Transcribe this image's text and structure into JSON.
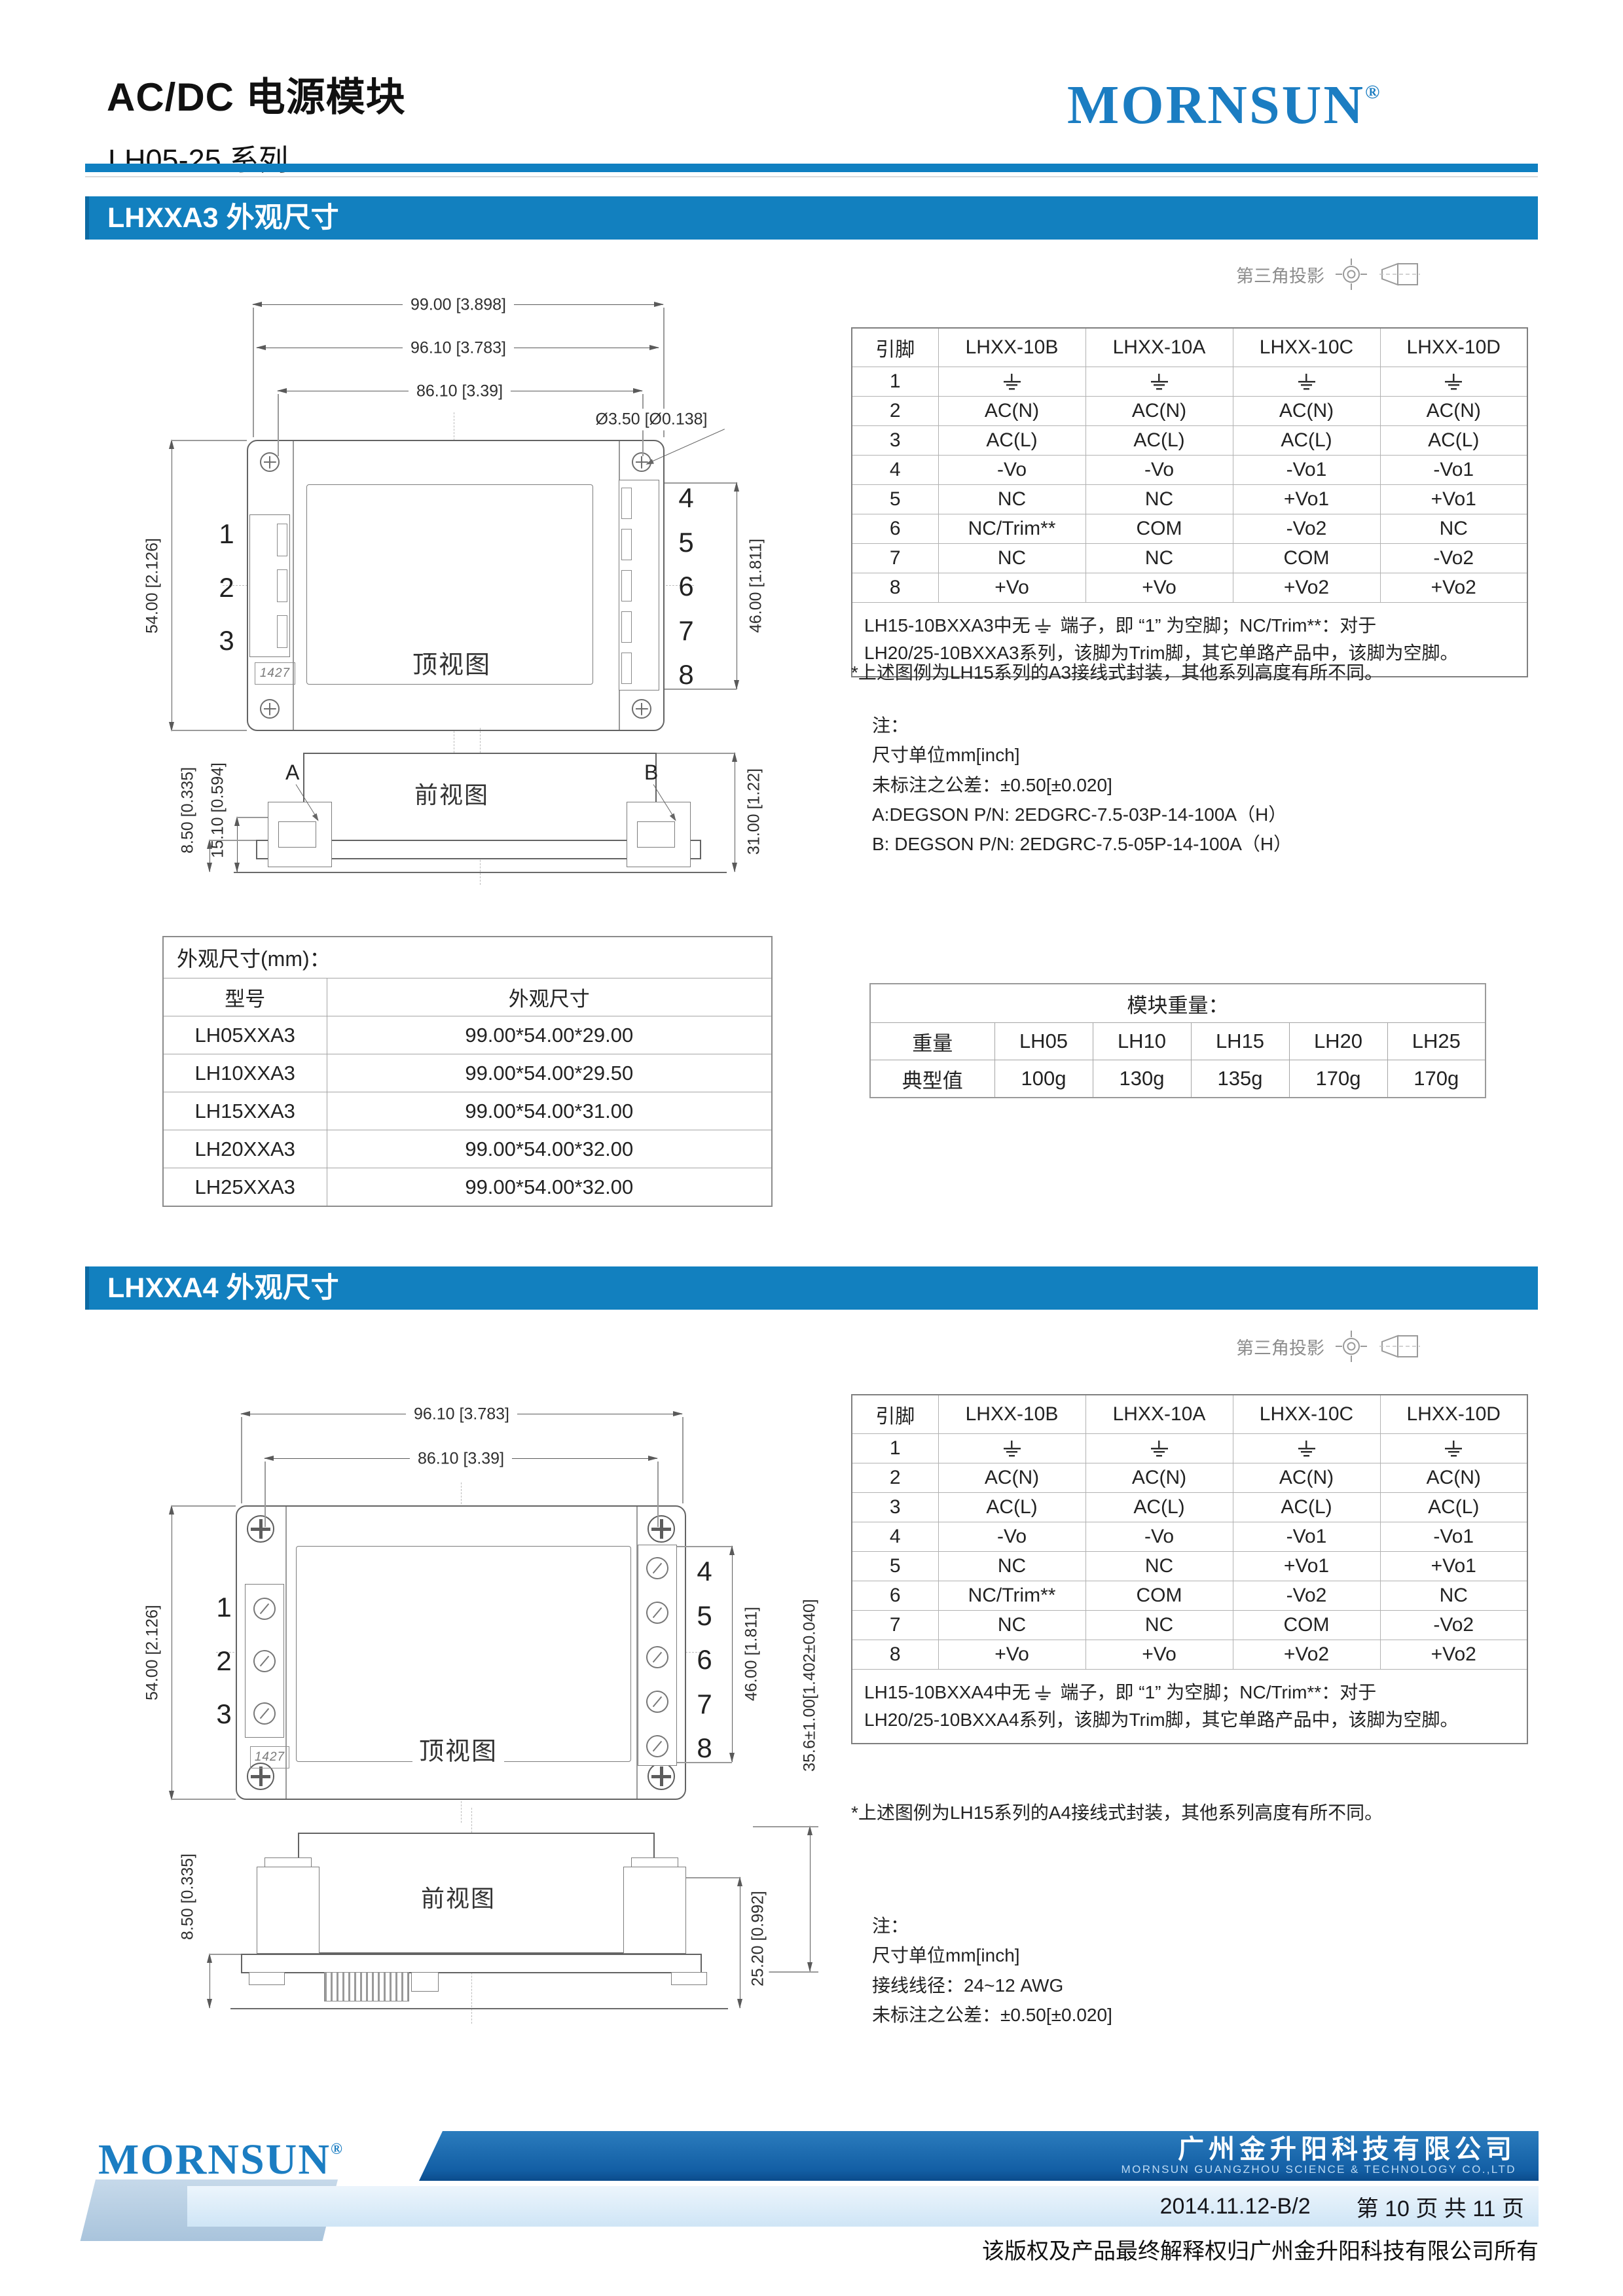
{
  "header": {
    "title": "AC/DC 电源模块",
    "series": "LH05-25 系列",
    "brand": "MORNSUN",
    "brand_reg": "®"
  },
  "projection_label": "第三角投影",
  "sections": {
    "a3": {
      "heading": "LHXXA3 外观尺寸",
      "top_view_label": "顶视图",
      "front_view_label": "前视图",
      "badge": "1427",
      "pins_left": [
        "1",
        "2",
        "3"
      ],
      "pins_right": [
        "4",
        "5",
        "6",
        "7",
        "8"
      ],
      "dims": {
        "top1": "99.00 [3.898]",
        "top2": "96.10 [3.783]",
        "top3": "86.10 [3.39]",
        "hole": "Ø3.50 [Ø0.138]",
        "left": "54.00 [2.126]",
        "right": "46.00 [1.811]",
        "front_d1": "8.50 [0.335]",
        "front_d2": "15.10 [0.594]",
        "front_right": "31.00 [1.22]",
        "label_a": "A",
        "label_b": "B"
      },
      "pin_table": {
        "headers": [
          "引脚",
          "LHXX-10B",
          "LHXX-10A",
          "LHXX-10C",
          "LHXX-10D"
        ],
        "rows": [
          [
            "1",
            "gnd",
            "gnd",
            "gnd",
            "gnd"
          ],
          [
            "2",
            "AC(N)",
            "AC(N)",
            "AC(N)",
            "AC(N)"
          ],
          [
            "3",
            "AC(L)",
            "AC(L)",
            "AC(L)",
            "AC(L)"
          ],
          [
            "4",
            "-Vo",
            "-Vo",
            "-Vo1",
            "-Vo1"
          ],
          [
            "5",
            "NC",
            "NC",
            "+Vo1",
            "+Vo1"
          ],
          [
            "6",
            "NC/Trim**",
            "COM",
            "-Vo2",
            "NC"
          ],
          [
            "7",
            "NC",
            "NC",
            "COM",
            "-Vo2"
          ],
          [
            "8",
            "+Vo",
            "+Vo",
            "+Vo2",
            "+Vo2"
          ]
        ],
        "note": {
          "pre": "LH15-10BXXA3中无",
          "post": " 端子，即 “1” 为空脚；NC/Trim**：对于",
          "line2": "LH20/25-10BXXA3系列，该脚为Trim脚，其它单路产品中，该脚为空脚。"
        }
      },
      "figure_note": "*上述图例为LH15系列的A3接线式封装，其他系列高度有所不同。",
      "notes": [
        "注：",
        "尺寸单位mm[inch]",
        "未标注之公差：±0.50[±0.020]",
        "A:DEGSON P/N: 2EDGRC-7.5-03P-14-100A（H）",
        "B: DEGSON P/N: 2EDGRC-7.5-05P-14-100A（H）"
      ]
    },
    "a4": {
      "heading": "LHXXA4 外观尺寸",
      "top_view_label": "顶视图",
      "front_view_label": "前视图",
      "badge": "1427",
      "pins_left": [
        "1",
        "2",
        "3"
      ],
      "pins_right": [
        "4",
        "5",
        "6",
        "7",
        "8"
      ],
      "dims": {
        "top1": "96.10 [3.783]",
        "top2": "86.10 [3.39]",
        "left": "54.00 [2.126]",
        "right": "46.00 [1.811]",
        "overall": "35.6±1.00[1.402±0.040]",
        "front_d1": "8.50 [0.335]",
        "front_right": "25.20 [0.992]"
      },
      "pin_table": {
        "headers": [
          "引脚",
          "LHXX-10B",
          "LHXX-10A",
          "LHXX-10C",
          "LHXX-10D"
        ],
        "rows": [
          [
            "1",
            "gnd",
            "gnd",
            "gnd",
            "gnd"
          ],
          [
            "2",
            "AC(N)",
            "AC(N)",
            "AC(N)",
            "AC(N)"
          ],
          [
            "3",
            "AC(L)",
            "AC(L)",
            "AC(L)",
            "AC(L)"
          ],
          [
            "4",
            "-Vo",
            "-Vo",
            "-Vo1",
            "-Vo1"
          ],
          [
            "5",
            "NC",
            "NC",
            "+Vo1",
            "+Vo1"
          ],
          [
            "6",
            "NC/Trim**",
            "COM",
            "-Vo2",
            "NC"
          ],
          [
            "7",
            "NC",
            "NC",
            "COM",
            "-Vo2"
          ],
          [
            "8",
            "+Vo",
            "+Vo",
            "+Vo2",
            "+Vo2"
          ]
        ],
        "note": {
          "pre": "LH15-10BXXA4中无",
          "post": " 端子，即 “1” 为空脚；NC/Trim**：对于",
          "line2": "LH20/25-10BXXA4系列，该脚为Trim脚，其它单路产品中，该脚为空脚。"
        }
      },
      "figure_note": "*上述图例为LH15系列的A4接线式封装，其他系列高度有所不同。",
      "notes": [
        "注：",
        "尺寸单位mm[inch]",
        "接线线径：24~12 AWG",
        "未标注之公差：±0.50[±0.020]"
      ]
    }
  },
  "size_table": {
    "title": "外观尺寸(mm)：",
    "headers": [
      "型号",
      "外观尺寸"
    ],
    "rows": [
      [
        "LH05XXA3",
        "99.00*54.00*29.00"
      ],
      [
        "LH10XXA3",
        "99.00*54.00*29.50"
      ],
      [
        "LH15XXA3",
        "99.00*54.00*31.00"
      ],
      [
        "LH20XXA3",
        "99.00*54.00*32.00"
      ],
      [
        "LH25XXA3",
        "99.00*54.00*32.00"
      ]
    ]
  },
  "weight_table": {
    "title": "模块重量：",
    "row1": [
      "重量",
      "LH05",
      "LH10",
      "LH15",
      "LH20",
      "LH25"
    ],
    "row2": [
      "典型值",
      "100g",
      "130g",
      "135g",
      "170g",
      "170g"
    ]
  },
  "footer": {
    "brand": "MORNSUN",
    "brand_reg": "®",
    "company_cn": "广州金升阳科技有限公司",
    "company_en": "MORNSUN GUANGZHOU SCIENCE & TECHNOLOGY CO.,LTD",
    "doc_code": "2014.11.12-B/2",
    "page_info": "第 10 页 共 11 页",
    "copyright": "该版权及产品最终解释权归广州金升阳科技有限公司所有"
  },
  "colors": {
    "accent_blue": "#1280bf",
    "logo_blue": "#1b7dc2",
    "footer_dark": "#135fa5",
    "footer_light": "#d8eaf8"
  }
}
